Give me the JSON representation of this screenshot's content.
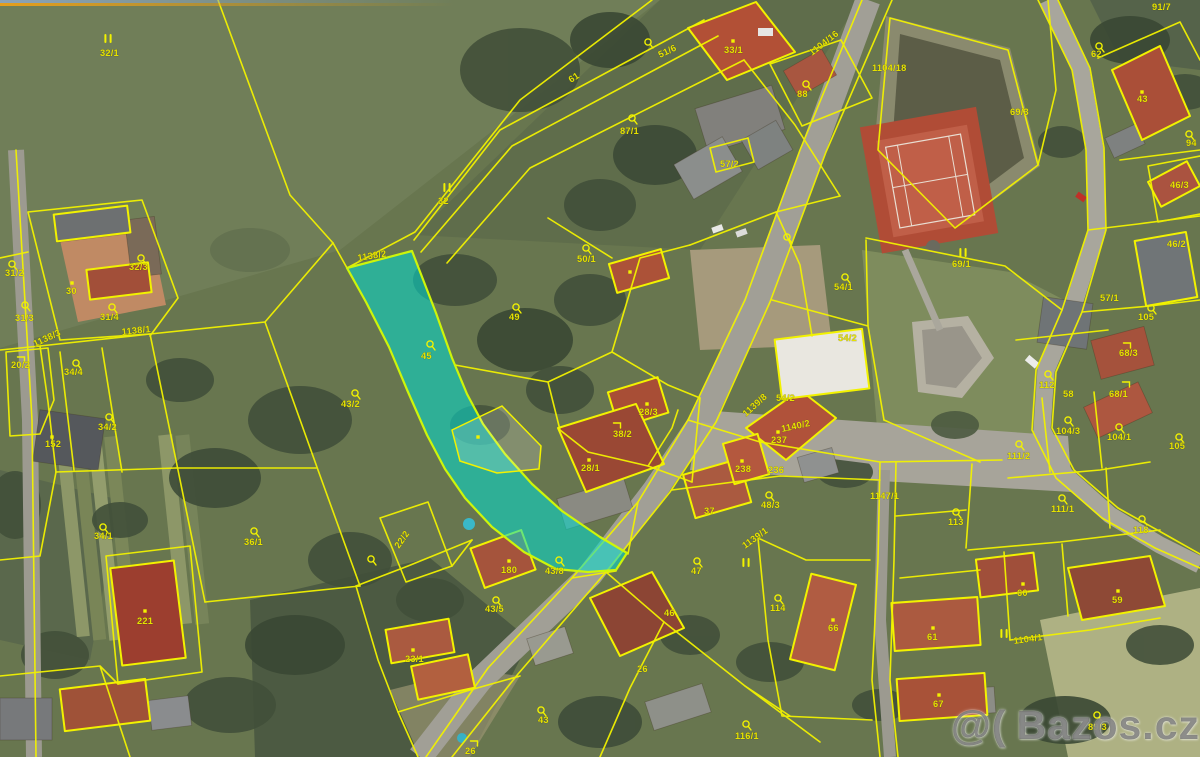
{
  "image": {
    "width": 1200,
    "height": 757,
    "kind": "cadastral-map-over-aerial-photo"
  },
  "watermark": {
    "icon": "@(",
    "text": "Bazos.cz"
  },
  "colors": {
    "parcel_line": "#f2f200",
    "label": "#e6e200",
    "highlight_fill": "#00ded2",
    "highlight_stroke": "#cdf50a",
    "road": "#a19f96",
    "field": "#68764f",
    "roof_red": "#aa5238",
    "tennis": "#b44f38"
  },
  "highlighted_parcel": {
    "number": "45",
    "related_line_label": "1138/2"
  },
  "labels": [
    {
      "t": "32/1",
      "x": 100,
      "y": 56
    },
    {
      "t": "32",
      "x": 438,
      "y": 204
    },
    {
      "t": "61",
      "x": 571,
      "y": 83,
      "r": -33
    },
    {
      "t": "51/6",
      "x": 660,
      "y": 58,
      "r": -25
    },
    {
      "t": "33/1",
      "x": 724,
      "y": 53
    },
    {
      "t": "87/1",
      "x": 620,
      "y": 134
    },
    {
      "t": "88",
      "x": 797,
      "y": 97
    },
    {
      "t": "1104/16",
      "x": 812,
      "y": 56,
      "r": -38
    },
    {
      "t": "1104/18",
      "x": 872,
      "y": 71
    },
    {
      "t": "91/7",
      "x": 1152,
      "y": 10
    },
    {
      "t": "62",
      "x": 1091,
      "y": 57
    },
    {
      "t": "69/3",
      "x": 1010,
      "y": 115
    },
    {
      "t": "43",
      "x": 1137,
      "y": 102
    },
    {
      "t": "94",
      "x": 1186,
      "y": 146
    },
    {
      "t": "46/3",
      "x": 1170,
      "y": 188
    },
    {
      "t": "46/2",
      "x": 1167,
      "y": 247
    },
    {
      "t": "57/1",
      "x": 1100,
      "y": 301
    },
    {
      "t": "57/2",
      "x": 720,
      "y": 167
    },
    {
      "t": "1138/2",
      "x": 358,
      "y": 261,
      "r": -9
    },
    {
      "t": "50/1",
      "x": 577,
      "y": 262
    },
    {
      "t": "49",
      "x": 509,
      "y": 320
    },
    {
      "t": "45",
      "x": 421,
      "y": 359
    },
    {
      "t": "43/2",
      "x": 341,
      "y": 407
    },
    {
      "t": "38/2",
      "x": 613,
      "y": 437
    },
    {
      "t": "28/3",
      "x": 639,
      "y": 415
    },
    {
      "t": "28/1",
      "x": 581,
      "y": 471
    },
    {
      "t": "54/1",
      "x": 834,
      "y": 290
    },
    {
      "t": "69/1",
      "x": 952,
      "y": 267
    },
    {
      "t": "54/2",
      "x": 838,
      "y": 341
    },
    {
      "t": "54/2",
      "x": 776,
      "y": 401
    },
    {
      "t": "1139/8",
      "x": 746,
      "y": 417,
      "r": -42
    },
    {
      "t": "1140/2",
      "x": 782,
      "y": 432,
      "r": -12
    },
    {
      "t": "237",
      "x": 771,
      "y": 443
    },
    {
      "t": "238",
      "x": 735,
      "y": 472
    },
    {
      "t": "236",
      "x": 768,
      "y": 473
    },
    {
      "t": "48/3",
      "x": 761,
      "y": 508
    },
    {
      "t": "1147/1",
      "x": 870,
      "y": 499
    },
    {
      "t": "37",
      "x": 704,
      "y": 514
    },
    {
      "t": "112",
      "x": 1039,
      "y": 388
    },
    {
      "t": "58",
      "x": 1063,
      "y": 397
    },
    {
      "t": "68/3",
      "x": 1119,
      "y": 356
    },
    {
      "t": "68/1",
      "x": 1109,
      "y": 397
    },
    {
      "t": "105",
      "x": 1138,
      "y": 320
    },
    {
      "t": "105",
      "x": 1169,
      "y": 449
    },
    {
      "t": "104/3",
      "x": 1056,
      "y": 434
    },
    {
      "t": "104/1",
      "x": 1107,
      "y": 440
    },
    {
      "t": "111/2",
      "x": 1007,
      "y": 459
    },
    {
      "t": "113",
      "x": 948,
      "y": 525
    },
    {
      "t": "111/1",
      "x": 1051,
      "y": 512
    },
    {
      "t": "118",
      "x": 1133,
      "y": 533
    },
    {
      "t": "60",
      "x": 1017,
      "y": 596
    },
    {
      "t": "59",
      "x": 1112,
      "y": 603
    },
    {
      "t": "66",
      "x": 828,
      "y": 631
    },
    {
      "t": "61",
      "x": 927,
      "y": 640
    },
    {
      "t": "67",
      "x": 933,
      "y": 707
    },
    {
      "t": "1104/1",
      "x": 1014,
      "y": 644,
      "r": -8
    },
    {
      "t": "89/3",
      "x": 1088,
      "y": 730
    },
    {
      "t": "116/1",
      "x": 735,
      "y": 739
    },
    {
      "t": "114",
      "x": 770,
      "y": 611
    },
    {
      "t": "47",
      "x": 691,
      "y": 574
    },
    {
      "t": "46",
      "x": 664,
      "y": 616
    },
    {
      "t": "26",
      "x": 637,
      "y": 672
    },
    {
      "t": "180",
      "x": 501,
      "y": 573
    },
    {
      "t": "43/8",
      "x": 545,
      "y": 574
    },
    {
      "t": "43/5",
      "x": 485,
      "y": 612
    },
    {
      "t": "23/1",
      "x": 405,
      "y": 662
    },
    {
      "t": "43",
      "x": 538,
      "y": 723
    },
    {
      "t": "26",
      "x": 465,
      "y": 754
    },
    {
      "t": "22/2",
      "x": 399,
      "y": 549,
      "r": -55
    },
    {
      "t": "1139/1",
      "x": 745,
      "y": 549,
      "r": -36
    },
    {
      "t": "36/1",
      "x": 244,
      "y": 545
    },
    {
      "t": "34/1",
      "x": 94,
      "y": 539
    },
    {
      "t": "221",
      "x": 137,
      "y": 624
    },
    {
      "t": "152",
      "x": 45,
      "y": 447
    },
    {
      "t": "34/2",
      "x": 98,
      "y": 430
    },
    {
      "t": "34/4",
      "x": 64,
      "y": 375
    },
    {
      "t": "20/2",
      "x": 11,
      "y": 368
    },
    {
      "t": "1138/1",
      "x": 122,
      "y": 335,
      "r": -6
    },
    {
      "t": "1138/3",
      "x": 35,
      "y": 347,
      "r": -25
    },
    {
      "t": "31/3",
      "x": 15,
      "y": 321
    },
    {
      "t": "31/4",
      "x": 100,
      "y": 320
    },
    {
      "t": "31/2",
      "x": 5,
      "y": 276
    },
    {
      "t": "32/3",
      "x": 129,
      "y": 270
    },
    {
      "t": "30",
      "x": 66,
      "y": 294
    }
  ],
  "symbols": [
    {
      "k": "grass",
      "x": 108,
      "y": 39
    },
    {
      "k": "grass",
      "x": 447,
      "y": 188
    },
    {
      "k": "grass",
      "x": 963,
      "y": 253
    },
    {
      "k": "grass",
      "x": 746,
      "y": 563
    },
    {
      "k": "grass",
      "x": 1004,
      "y": 634
    },
    {
      "k": "tree",
      "x": 648,
      "y": 43
    },
    {
      "k": "tree",
      "x": 632,
      "y": 119
    },
    {
      "k": "tree",
      "x": 806,
      "y": 85
    },
    {
      "k": "tree",
      "x": 787,
      "y": 238
    },
    {
      "k": "tree",
      "x": 586,
      "y": 249
    },
    {
      "k": "tree",
      "x": 516,
      "y": 308
    },
    {
      "k": "tree",
      "x": 430,
      "y": 345
    },
    {
      "k": "tree",
      "x": 355,
      "y": 394
    },
    {
      "k": "tree",
      "x": 1099,
      "y": 47
    },
    {
      "k": "tree",
      "x": 1189,
      "y": 135
    },
    {
      "k": "tree",
      "x": 845,
      "y": 278
    },
    {
      "k": "tree",
      "x": 1151,
      "y": 309
    },
    {
      "k": "tree",
      "x": 1048,
      "y": 375
    },
    {
      "k": "tree",
      "x": 1068,
      "y": 421
    },
    {
      "k": "tree",
      "x": 1119,
      "y": 428
    },
    {
      "k": "tree",
      "x": 1019,
      "y": 445
    },
    {
      "k": "tree",
      "x": 1179,
      "y": 438
    },
    {
      "k": "tree",
      "x": 956,
      "y": 513
    },
    {
      "k": "tree",
      "x": 1062,
      "y": 499
    },
    {
      "k": "tree",
      "x": 1142,
      "y": 520
    },
    {
      "k": "tree",
      "x": 697,
      "y": 562
    },
    {
      "k": "tree",
      "x": 778,
      "y": 599
    },
    {
      "k": "tree",
      "x": 746,
      "y": 725
    },
    {
      "k": "tree",
      "x": 1097,
      "y": 716
    },
    {
      "k": "tree",
      "x": 371,
      "y": 560
    },
    {
      "k": "tree",
      "x": 559,
      "y": 561
    },
    {
      "k": "tree",
      "x": 496,
      "y": 601
    },
    {
      "k": "tree",
      "x": 541,
      "y": 711
    },
    {
      "k": "tree",
      "x": 254,
      "y": 532
    },
    {
      "k": "tree",
      "x": 103,
      "y": 528
    },
    {
      "k": "tree",
      "x": 12,
      "y": 265
    },
    {
      "k": "tree",
      "x": 141,
      "y": 259
    },
    {
      "k": "tree",
      "x": 25,
      "y": 306
    },
    {
      "k": "tree",
      "x": 112,
      "y": 308
    },
    {
      "k": "tree",
      "x": 76,
      "y": 364
    },
    {
      "k": "tree",
      "x": 109,
      "y": 418
    },
    {
      "k": "tree",
      "x": 769,
      "y": 496
    },
    {
      "k": "corner",
      "x": 617,
      "y": 426
    },
    {
      "k": "corner",
      "x": 1127,
      "y": 346
    },
    {
      "k": "corner",
      "x": 21,
      "y": 360
    },
    {
      "k": "corner",
      "x": 474,
      "y": 744
    },
    {
      "k": "corner",
      "x": 1126,
      "y": 385
    },
    {
      "k": "dot",
      "x": 733,
      "y": 41
    },
    {
      "k": "dot",
      "x": 72,
      "y": 283
    },
    {
      "k": "dot",
      "x": 145,
      "y": 611
    },
    {
      "k": "dot",
      "x": 509,
      "y": 561
    },
    {
      "k": "dot",
      "x": 933,
      "y": 628
    },
    {
      "k": "dot",
      "x": 939,
      "y": 695
    },
    {
      "k": "dot",
      "x": 1023,
      "y": 584
    },
    {
      "k": "dot",
      "x": 1118,
      "y": 591
    },
    {
      "k": "dot",
      "x": 647,
      "y": 404
    },
    {
      "k": "dot",
      "x": 589,
      "y": 460
    },
    {
      "k": "dot",
      "x": 742,
      "y": 461
    },
    {
      "k": "dot",
      "x": 778,
      "y": 432
    },
    {
      "k": "dot",
      "x": 1142,
      "y": 92
    },
    {
      "k": "dot",
      "x": 413,
      "y": 650
    },
    {
      "k": "dot",
      "x": 833,
      "y": 620
    },
    {
      "k": "dot",
      "x": 52,
      "y": 437
    },
    {
      "k": "dot",
      "x": 478,
      "y": 437
    },
    {
      "k": "dot",
      "x": 630,
      "y": 272
    }
  ]
}
